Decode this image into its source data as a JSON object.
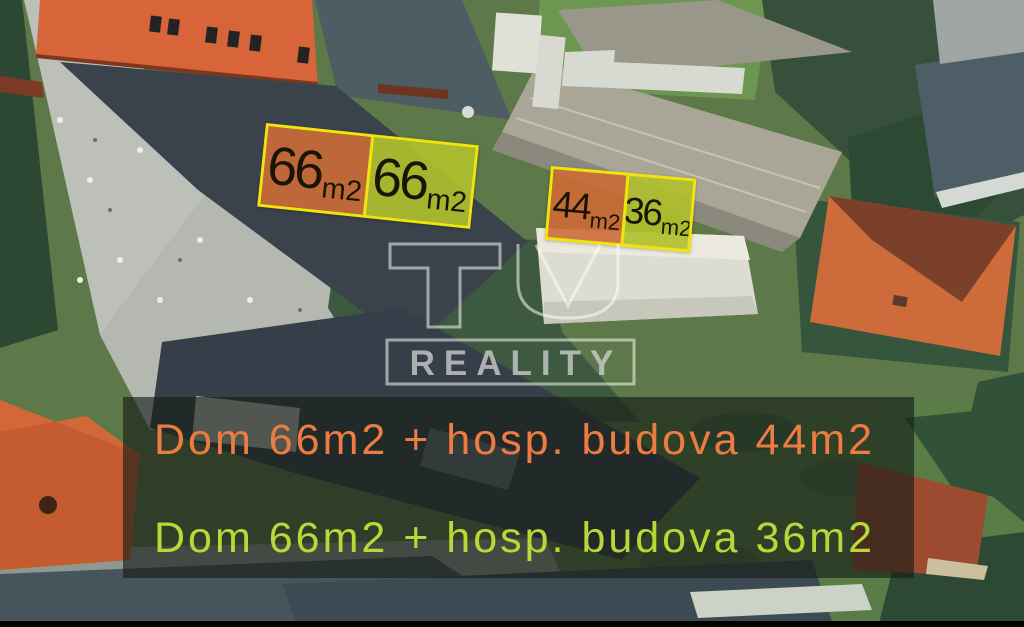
{
  "watermark": {
    "top_text": "TU",
    "bottom_text": "REALITY"
  },
  "area_labels": {
    "group1": {
      "left": {
        "value": "66",
        "unit": "m2"
      },
      "right": {
        "value": "66",
        "unit": "m2"
      }
    },
    "group2": {
      "left": {
        "value": "44",
        "unit": "m2"
      },
      "right": {
        "value": "36",
        "unit": "m2"
      }
    }
  },
  "banner": {
    "lines": [
      {
        "text": "Dom 66m2 + hosp. budova 44m2"
      },
      {
        "text": "Dom 66m2 + hosp. budova 36m2"
      }
    ]
  },
  "colors": {
    "label_orange": "#cd6c36e6",
    "label_green": "#b0c02ce8",
    "label_border": "#f0e40a",
    "label_text": "#1a1503",
    "banner_bg": "#161c16a1",
    "banner_text_orange": "#ec7c41",
    "banner_text_green": "#b9d737",
    "watermark_stroke": "#ffffff87",
    "watermark_fill": "#d0d0d0c4"
  }
}
